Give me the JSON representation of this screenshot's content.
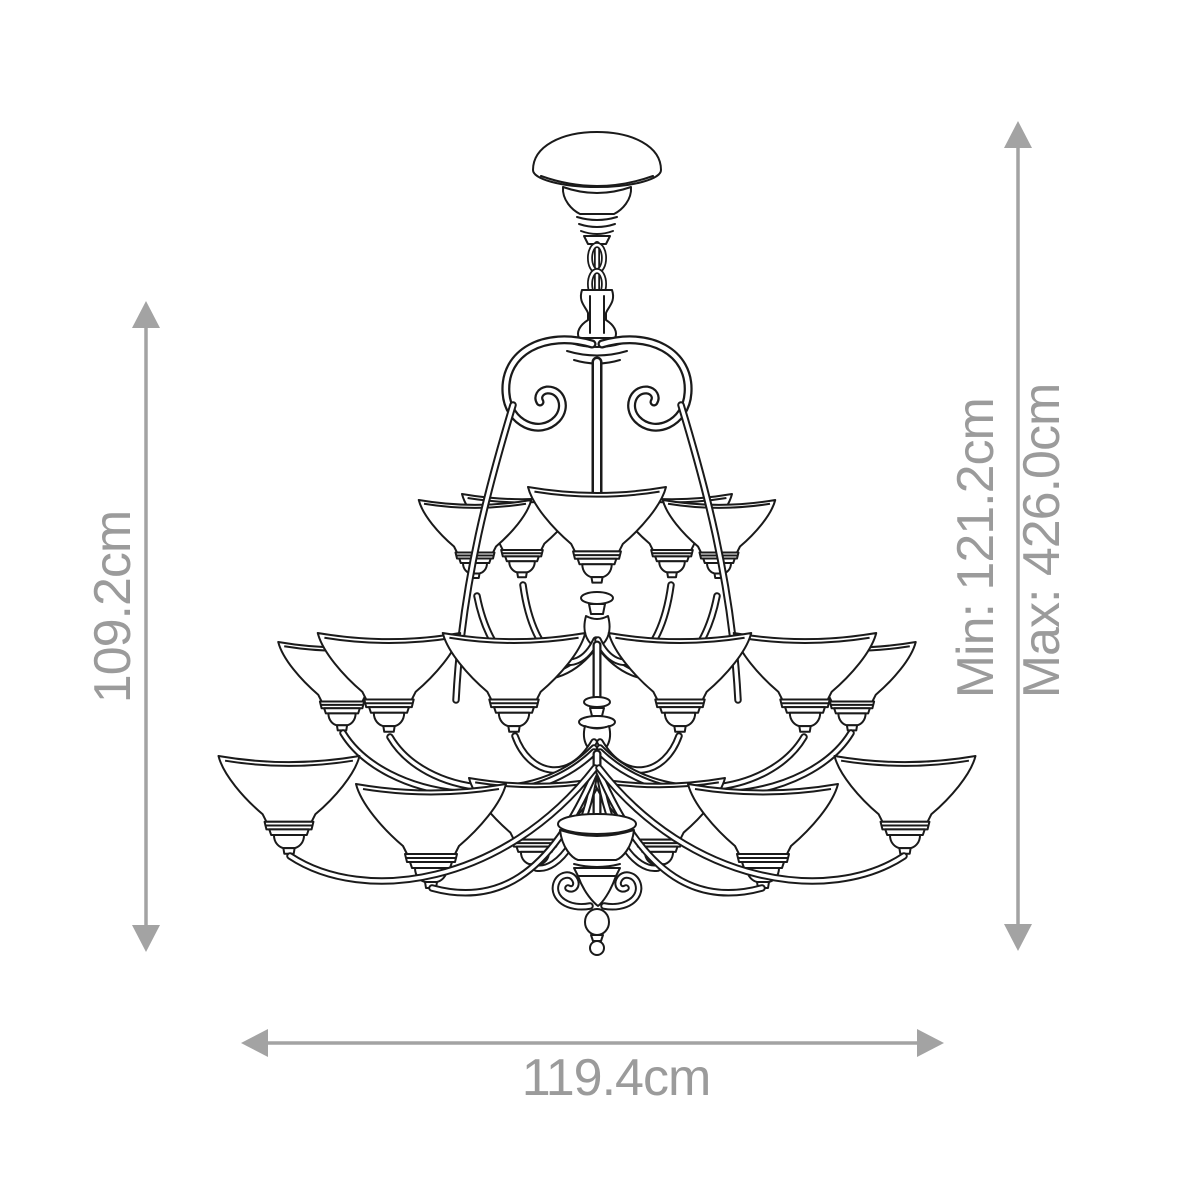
{
  "diagram": {
    "type": "product-dimension-diagram",
    "subject": "three-tier chandelier line drawing",
    "background_color": "#ffffff",
    "line_color": "#1a1a1a",
    "dimension_color": "#9b9b9b",
    "arrow_color": "#a3a3a3",
    "dimensions": {
      "fixture_height": "109.2cm",
      "hang_min": "Min: 121.2cm",
      "hang_max": "Max: 426.0cm",
      "width": "119.4cm"
    }
  }
}
